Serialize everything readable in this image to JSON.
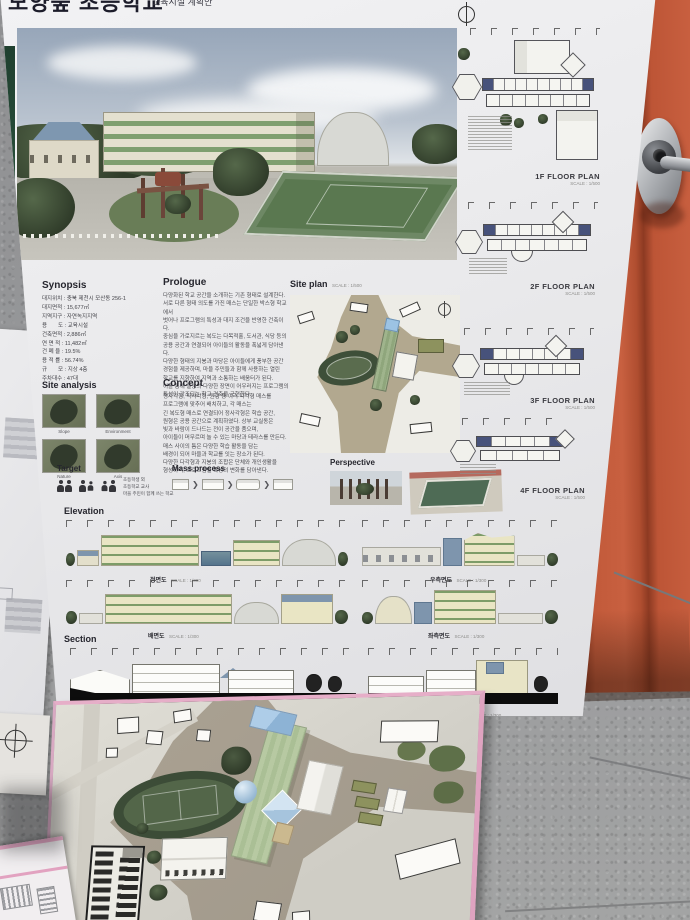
{
  "poster": {
    "title": "모양숲 초등학교",
    "subtitle": "교육시설 계획안",
    "synopsis": {
      "heading": "Synopsis",
      "items": [
        "대지위치 : 충북 제천시 모산동 256-1",
        "대지면적 : 15,677㎡",
        "지역지구 : 자연녹지지역",
        "용　　도 : 교육시설",
        "건축면적 : 2,886㎡",
        "연 면 적 : 11,482㎡",
        "건 폐 율 : 19.5%",
        "용 적 률 : 56.74%",
        "규　　모 : 지상 4층",
        "주차대수 : 47대"
      ]
    },
    "prologue": {
      "heading": "Prologue",
      "text": "다양화된 학교 공간을 소개하는 기존 형태로 설계한다.\n서로 다른 형태 의도를 가진 매스는 단일한 박스형 학교에서\n벗어나 프로그램의 특성과 대지 조건을 반영한 건축이다.\n중심을 가로지르는 복도는 다목적홀, 도서관, 식당 등의\n공용 공간과 연결되어 아이들의 활동을 폭넓게 담아낸다.\n다양한 형태의 지붕과 마당은 아이들에게 풍부한 공간\n경험을 제공하며, 마을 주민들과 함께 사용하는 열린\n학교를 지향하여 지역과 소통하는 배움터가 된다.\n이를 통해 일상의 다양한 장면이 어우러지는 프로그램의\n특성이 강조되는 학교 건축을 구현한다."
    },
    "site_plan": {
      "heading": "Site plan",
      "scale": "SCALE : 1/500"
    },
    "site_analysis": {
      "heading": "Site analysis",
      "thumbs": [
        "Slope",
        "Environment",
        "Nature",
        "Axis"
      ]
    },
    "concept": {
      "heading": "Concept",
      "text": "정사각형, 직사각형, 원형 등 여러 다각형 매스를\n프로그램에 맞추어 배치하고, 각 매스는\n긴 복도형 매스로 연결되어 정사각형은 학습 공간,\n원형은 공용 공간으로 계획하였다. 상부 교실동은\n빛과 바람이 드나드는 전이 공간을 품으며,\n아이들이 머무르며 놀 수 있는 마당과 테라스를 만든다.\n매스 사이의 틈은 다양한 학습 활동을 담는\n배경이 되어 마을과 학교를 잇는 장소가 된다.\n다양한 다각형과 지붕의 조합은 단체와 개인생활을\n형성하며, 프로그램별 특성의 변화를 담아낸다."
    },
    "target": {
      "heading": "Target",
      "caption": "초등학생 외\n초등학교 교사\n마을 주민이 함께 쓰는 학교"
    },
    "mass_process": {
      "heading": "Mass process",
      "arrow": "❯"
    },
    "perspective": {
      "heading": "Perspective"
    },
    "elevation": {
      "heading": "Elevation",
      "items": [
        {
          "label": "정면도",
          "scale": "SCALE : 1/300"
        },
        {
          "label": "우측면도",
          "scale": "SCALE : 1/300"
        },
        {
          "label": "배면도",
          "scale": "SCALE : 1/300"
        },
        {
          "label": "좌측면도",
          "scale": "SCALE : 1/300"
        }
      ]
    },
    "section": {
      "heading": "Section",
      "items": [
        {
          "label": "A-A' SECTION",
          "scale": "SCALE : 1/300"
        },
        {
          "label": "B-B' SECTION",
          "scale": "SCALE : 1/300"
        }
      ]
    },
    "floor_plans": [
      {
        "label": "1F FLOOR PLAN",
        "scale": "SCALE : 1/500"
      },
      {
        "label": "2F FLOOR PLAN",
        "scale": "SCALE : 1/500"
      },
      {
        "label": "3F FLOOR PLAN",
        "scale": "SCALE : 1/500"
      },
      {
        "label": "4F FLOOR PLAN",
        "scale": "SCALE : 1/500"
      }
    ]
  }
}
